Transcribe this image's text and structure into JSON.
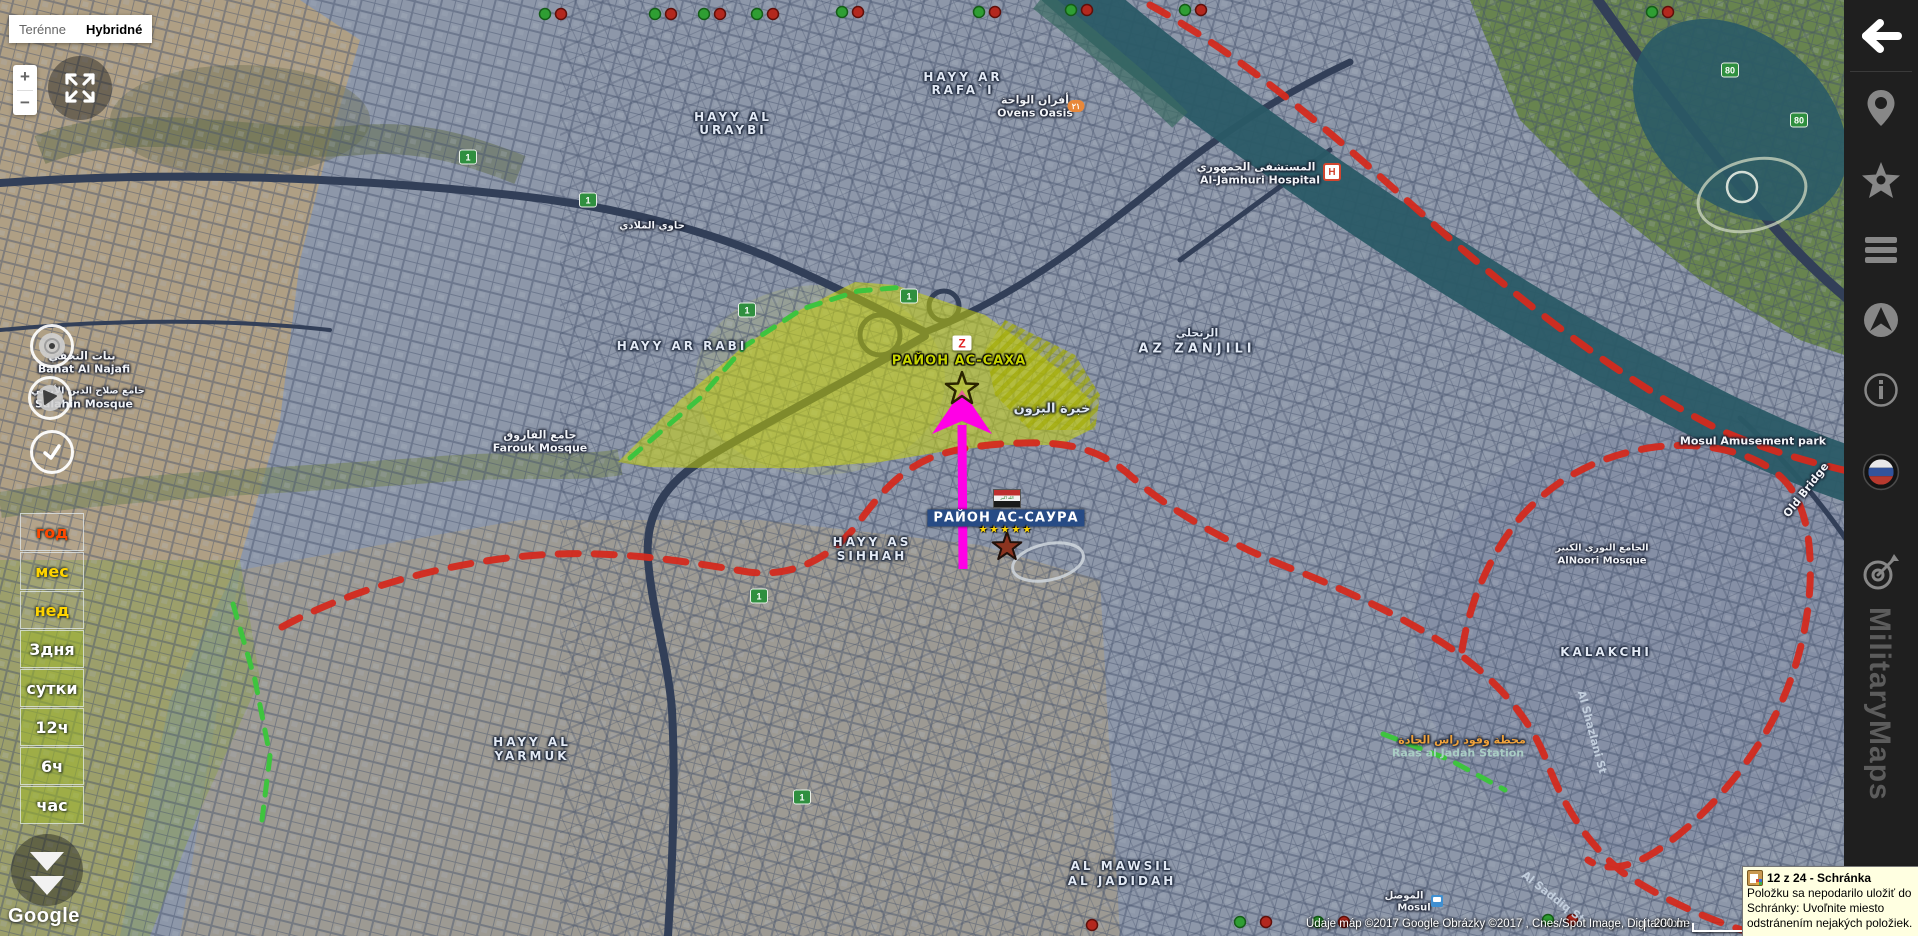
{
  "map_type_toggle": {
    "terrain_label": "Terénne",
    "hybrid_label": "Hybridné"
  },
  "zoom_control": {
    "zoom_in": "+",
    "zoom_out": "−"
  },
  "time_filters": {
    "items": [
      {
        "label": "год"
      },
      {
        "label": "мес"
      },
      {
        "label": "нед"
      },
      {
        "label": "3дня"
      },
      {
        "label": "сутки"
      },
      {
        "label": "12ч"
      },
      {
        "label": "6ч"
      },
      {
        "label": "час"
      }
    ]
  },
  "zones": {
    "saha_label": "РАЙОН АС-САХА",
    "saura_label": "РАЙОН АС-САУРА",
    "saura_stars": "★★★★★"
  },
  "shields": {
    "route1": "1",
    "route80": "80"
  },
  "badges": {
    "ovens_badge": "٢١",
    "hospital": "H",
    "z_logo": "Z"
  },
  "districts": [
    {
      "text": "HAYY AL"
    },
    {
      "text": "URAYBI"
    },
    {
      "text": "HAYY AR"
    },
    {
      "text": "RAFA`I"
    },
    {
      "text": "الزنجلي"
    },
    {
      "text": "AZ ZANJILI"
    },
    {
      "text": "HAYY AR RABI"
    },
    {
      "text": "HAYY AS"
    },
    {
      "text": "SIHHAH"
    },
    {
      "text": "HAYY AL"
    },
    {
      "text": "YARMUK"
    },
    {
      "text": "AL MAWSIL"
    },
    {
      "text": "AL JADIDAH"
    },
    {
      "text": "KALAKCHI"
    }
  ],
  "pois": [
    {
      "text": "أفران الواحة"
    },
    {
      "text": "Ovens Oasis"
    },
    {
      "text": "المستشفى الجمهوري"
    },
    {
      "text": "Al-Jamhuri Hospital"
    },
    {
      "text": "بنات النجفي"
    },
    {
      "text": "Banat Al Najafi"
    },
    {
      "text": "جامع صلاح الدين الأيوبي"
    },
    {
      "text": "Salahin Mosque"
    },
    {
      "text": "جامع الفاروق"
    },
    {
      "text": "Farouk Mosque"
    },
    {
      "text": "خبرة البزون"
    },
    {
      "text": "Mosul Amusement park"
    },
    {
      "text": "Old Bridge"
    },
    {
      "text": "الجامع النوري الكبير"
    },
    {
      "text": "AlNoori Mosque"
    },
    {
      "text": "محطة وقود راس الجادة"
    },
    {
      "text": "Raas al Jadah Station"
    },
    {
      "text": "الموصل"
    },
    {
      "text": "Mosul"
    },
    {
      "text": "Al Shazlani St"
    },
    {
      "text": "Al Saddiq St"
    },
    {
      "text": "حاوي الملادي"
    }
  ],
  "google_logo": "Google",
  "attribution": {
    "text": "Údaje máp ©2017 Google Obrázky ©2017 , Cnes/Spot Image, DigitalGlobe",
    "scale": "200 m"
  },
  "sidebar": {
    "brand": "MilitaryMaps"
  },
  "popup": {
    "title": "12 z 24 - Schránka",
    "line1": "Položku sa nepodarilo uložiť do",
    "line2": "Schránky: Uvoľnite miesto",
    "line3": "odstránením nejakých položiek."
  },
  "colors": {
    "accent_magenta": "#ff00e6",
    "zone_yellow": "#c8d400",
    "front_line_red": "#d42a1e",
    "dash_green": "#3ec43e",
    "water_teal": "#2a5a66"
  }
}
